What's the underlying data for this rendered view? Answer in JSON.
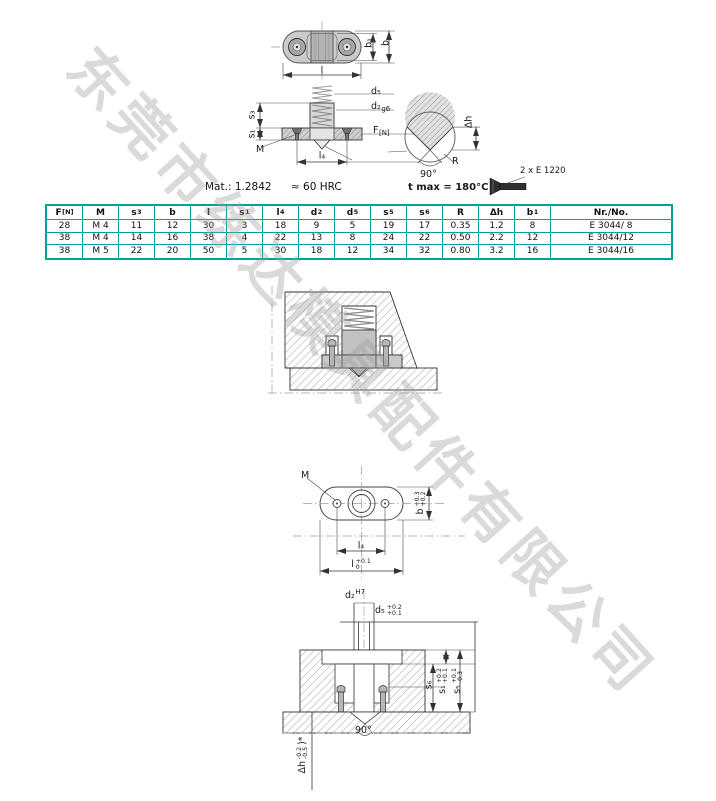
{
  "watermark": {
    "text": "东莞市练达模具配件有限公司"
  },
  "colors": {
    "table_border": "#00a29b",
    "watermark": "#9f9f9f",
    "part_fill": "#cbcbcb",
    "hatch_line": "#9a9a9a",
    "screw_fill": "#2e2e2e"
  },
  "notes": {
    "material": "Mat.: 1.2842",
    "hardness": "≈ 60 HRC",
    "t_max": "t max = 180°C",
    "screw_ref": "2 x E 1220"
  },
  "top_view": {
    "b1": "b₁",
    "b": "b",
    "l": "l"
  },
  "section": {
    "d5": "d₅",
    "d2": "d₂",
    "d2_fit": "g6",
    "s3": "s₃",
    "s1": "s₁",
    "force": "F",
    "force_sub": "[N]",
    "thread": "M",
    "l4": "l₄",
    "dh": "Δh",
    "radius": "R",
    "angle": "90°"
  },
  "table": {
    "headers": [
      {
        "t": "F",
        "s": "[N]"
      },
      {
        "t": "M"
      },
      {
        "t": "s",
        "s": "3"
      },
      {
        "t": "b"
      },
      {
        "t": "l"
      },
      {
        "t": "s",
        "s": "1"
      },
      {
        "t": "l",
        "s": "4"
      },
      {
        "t": "d",
        "s": "2"
      },
      {
        "t": "d",
        "s": "5"
      },
      {
        "t": "s",
        "s": "5"
      },
      {
        "t": "s",
        "s": "6"
      },
      {
        "t": "R"
      },
      {
        "t": "Δh"
      },
      {
        "t": "b",
        "s": "1"
      },
      {
        "t": "Nr./No."
      }
    ],
    "rows": [
      [
        "28",
        "M 4",
        "11",
        "12",
        "30",
        "3",
        "18",
        "9",
        "5",
        "19",
        "17",
        "0.35",
        "1.2",
        "8",
        "E 3044/ 8"
      ],
      [
        "38",
        "M 4",
        "14",
        "16",
        "38",
        "4",
        "22",
        "13",
        "8",
        "24",
        "22",
        "0.50",
        "2.2",
        "12",
        "E 3044/12"
      ],
      [
        "38",
        "M 5",
        "22",
        "20",
        "50",
        "5",
        "30",
        "18",
        "12",
        "34",
        "32",
        "0.80",
        "3.2",
        "16",
        "E 3044/16"
      ]
    ]
  },
  "bottom_view": {
    "thread": "M",
    "l4": "l₄",
    "l": "l",
    "l_tol_top": "+0.1",
    "l_tol_bottom": "0",
    "b": "b",
    "b_tol_top": "+0.3",
    "b_tol_bottom": "+0.2"
  },
  "bottom_section": {
    "d2": "d₂",
    "d2_fit": "H7",
    "d5": "d₅",
    "d5_tol_top": "+0.2",
    "d5_tol_bottom": "+0.1",
    "s6": "s₆",
    "s1": "s₁",
    "s1_tol_top": "+0.2",
    "s1_tol_bottom": "+0.1",
    "s5": "s₅",
    "s5_tol_top": "+0.1",
    "s5_tol_bottom": "-0.3",
    "angle": "90°",
    "dh": "Δh",
    "dh_tol_top": "-0.2",
    "dh_tol_bottom": "-0.5",
    "dh_note": ")*"
  }
}
